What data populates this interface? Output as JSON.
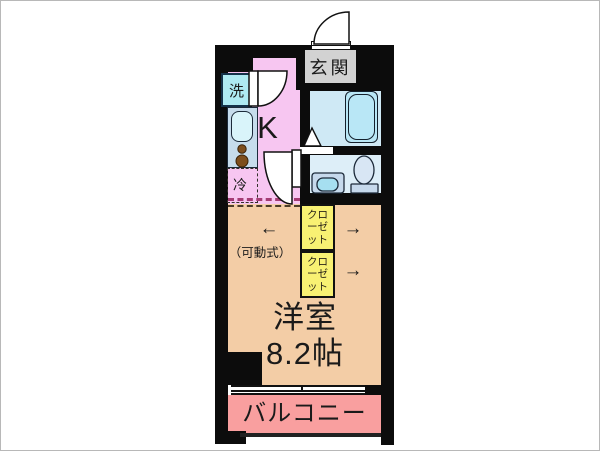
{
  "colors": {
    "wall": "#0c0c0c",
    "kitchen": "#f7c6f1",
    "entrance": "#d2d2d2",
    "bath": "#cfe9f5",
    "toilet": "#ddeef8",
    "closet": "#f8f173",
    "room": "#f3cda6",
    "balcony": "#f99f9f",
    "washer": "#aeeaf2",
    "counter": "#c6dcec",
    "sinkFill": "#d9f4fa",
    "tubFill": "#b9e7f6",
    "fixture": "#c6d9ec",
    "basin": "#a6dff0",
    "burner": "#7d4e1d",
    "text": "#1a1a1a",
    "dashPink": "#a43c74",
    "dashDark": "#4c3c28"
  },
  "labels": {
    "kitchen": "K",
    "entrance": "玄関",
    "washer": "洗",
    "fridge": "冷",
    "closet_upper": "クローゼット",
    "closet_lower": "クローゼット",
    "room_name": "洋室",
    "room_size": "8.2帖",
    "balcony": "バルコニー",
    "movable_note": "（可動式）",
    "arrow_left": "←",
    "arrow_right_upper": "→",
    "arrow_right_lower": "→"
  }
}
